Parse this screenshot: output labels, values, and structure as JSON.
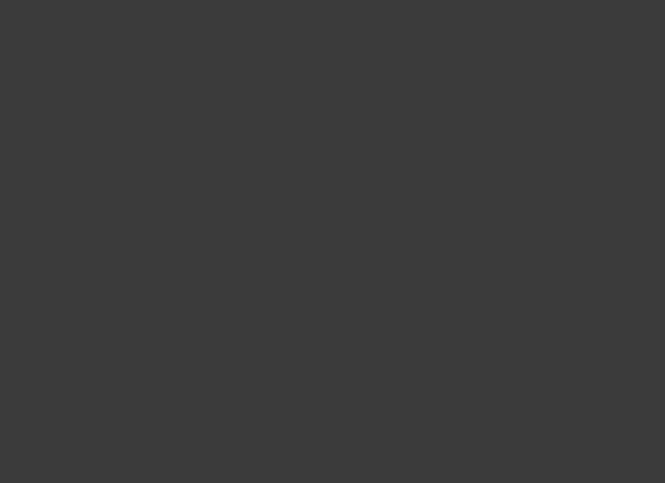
{
  "palette": {
    "frame": "#3b3b3b",
    "page": "#ebebeb",
    "floor": "#fbfbfa",
    "wall": "#1d1d1d",
    "green": "#61a23c",
    "green_line": "#a3c38b",
    "red": "#b2271a",
    "red_line": "#dfa098",
    "hatch_base": "#d9d9d9",
    "hatch_line": "#8f8f8f",
    "label": "#6b6b6b",
    "dark_fixture": "#202020"
  },
  "blocks": {
    "main": [
      88,
      55,
      560,
      373
    ],
    "top_band": [
      88,
      29,
      467,
      26
    ],
    "top_right_band": [
      555,
      29,
      93,
      26
    ],
    "left_wing": [
      38,
      112,
      50,
      343
    ],
    "top_left_block": [
      52,
      40,
      42,
      40
    ],
    "bottom_left_block": [
      88,
      390,
      222,
      65
    ],
    "restroom_block": [
      428,
      412,
      97,
      40
    ],
    "bottom_right_block": [
      555,
      390,
      93,
      68
    ],
    "skylight": [
      522,
      22,
      34,
      42
    ],
    "stair_core": [
      564,
      54,
      46,
      40
    ],
    "top_right_room": [
      612,
      56,
      36,
      48
    ],
    "rental_room": [
      555,
      135,
      73,
      87
    ],
    "kfc": [
      558,
      222,
      70,
      170
    ],
    "boh_strip": [
      152,
      58,
      22,
      172
    ],
    "right_rooms": [
      [
        628,
        146,
        20,
        44
      ],
      [
        628,
        194,
        20,
        44
      ],
      [
        628,
        242,
        20,
        44
      ],
      [
        628,
        290,
        20,
        44
      ],
      [
        628,
        338,
        20,
        44
      ],
      [
        628,
        386,
        20,
        44
      ]
    ]
  },
  "lines": {
    "grid": [
      [
        88,
        220,
        648,
        220
      ]
    ],
    "thin": [
      [
        514,
        133,
        514,
        390
      ],
      [
        556,
        133,
        556,
        282
      ],
      [
        556,
        304,
        556,
        390
      ],
      [
        150,
        400,
        310,
        400
      ],
      [
        310,
        412,
        428,
        412
      ],
      [
        428,
        428,
        525,
        428
      ],
      [
        88,
        133,
        514,
        133
      ]
    ],
    "wing_dividers": [
      [
        38,
        162,
        88,
        162
      ],
      [
        38,
        210,
        88,
        210
      ],
      [
        38,
        232,
        88,
        232
      ],
      [
        38,
        258,
        88,
        258
      ],
      [
        38,
        290,
        88,
        290
      ],
      [
        38,
        318,
        88,
        318
      ],
      [
        38,
        350,
        88,
        350
      ],
      [
        38,
        390,
        88,
        390
      ],
      [
        38,
        420,
        88,
        420
      ]
    ]
  },
  "shops_row": {
    "x0": 95,
    "y": 31,
    "count": 14,
    "step": 30.5,
    "w": 26,
    "h": 22
  },
  "dark_rows": [
    {
      "x0": 152,
      "y": 44,
      "count": 23,
      "step": 16,
      "w": 9,
      "h": 10
    },
    {
      "x0": 334,
      "y": 100,
      "count": 24,
      "step": 9.2,
      "w": 6.5,
      "h": 8
    }
  ],
  "shelf_groups": [
    {
      "id": "aisles-left-upper",
      "x": 293,
      "w": 88,
      "h": 8,
      "style": "xend",
      "ys": [
        153,
        168,
        183,
        198,
        213,
        228,
        243,
        258,
        273
      ]
    },
    {
      "id": "aisles-right-upper",
      "x": 417,
      "w": 88,
      "h": 8,
      "style": "plain",
      "ys": [
        158,
        173,
        188,
        203,
        218,
        233,
        248,
        263,
        278
      ]
    },
    {
      "id": "aisles-left-lower",
      "x": 293,
      "w": 88,
      "h": 8,
      "style": "xend",
      "ys": [
        312,
        327,
        342,
        372
      ]
    },
    {
      "id": "aisles-right-lower",
      "x": 417,
      "w": 88,
      "h": 8,
      "style": "plain",
      "ys": [
        312,
        327,
        342,
        372
      ]
    }
  ],
  "promo_rows": [
    {
      "y": 293,
      "s": 12,
      "xs": [
        298,
        326,
        354,
        382,
        428,
        456,
        484,
        506
      ]
    },
    {
      "y": 140,
      "s": 12,
      "xs": [
        300,
        330,
        360,
        428,
        458,
        488
      ]
    }
  ],
  "vshelves": {
    "x0": 336,
    "y": 58,
    "count": 8,
    "step": 17,
    "w": 10,
    "h": 40
  },
  "grid_tables": [
    [
      201,
      140,
      22,
      13
    ],
    [
      201,
      157,
      22,
      13
    ],
    [
      218,
      172,
      24,
      13
    ],
    [
      247,
      172,
      24,
      13
    ],
    [
      276,
      172,
      24,
      13
    ],
    [
      218,
      190,
      24,
      13
    ],
    [
      247,
      190,
      24,
      13
    ],
    [
      276,
      190,
      24,
      13
    ],
    [
      218,
      209,
      24,
      13
    ],
    [
      247,
      209,
      24,
      13
    ],
    [
      276,
      209,
      24,
      13
    ],
    [
      224,
      233,
      24,
      13
    ],
    [
      253,
      233,
      24,
      13
    ],
    [
      282,
      233,
      24,
      13
    ],
    [
      224,
      250,
      24,
      13
    ],
    [
      253,
      250,
      24,
      13
    ],
    [
      282,
      250,
      24,
      13
    ],
    [
      146,
      333,
      26,
      13
    ],
    [
      146,
      349,
      26,
      13
    ]
  ],
  "rings": [
    [
      147,
      132,
      40,
      36
    ],
    [
      232,
      132,
      40,
      36
    ]
  ],
  "vrings": [
    [
      205,
      314,
      29,
      48
    ],
    [
      243,
      314,
      29,
      48
    ]
  ],
  "ovals": [
    [
      142,
      182,
      50,
      14
    ],
    [
      142,
      202,
      50,
      14
    ],
    [
      142,
      239,
      50,
      13
    ]
  ],
  "freezers": [
    [
      143,
      266,
      48,
      11
    ],
    [
      199,
      266,
      34,
      11
    ],
    [
      243,
      266,
      26,
      11
    ],
    [
      143,
      284,
      48,
      11
    ],
    [
      199,
      284,
      34,
      11
    ],
    [
      243,
      284,
      26,
      11
    ]
  ],
  "circles": [
    [
      150,
      323,
      5
    ],
    [
      164,
      323,
      5
    ],
    [
      178,
      323,
      5
    ],
    [
      527,
      92,
      8
    ]
  ],
  "deli": {
    "u": [
      [
        148,
        60,
        70,
        9
      ],
      [
        148,
        88,
        70,
        9
      ],
      [
        148,
        69,
        9,
        19
      ]
    ],
    "inner": [
      170,
      72,
      26,
      13
    ],
    "blobs": [
      [
        175,
        74,
        7,
        5
      ],
      [
        185,
        74,
        7,
        5
      ]
    ]
  },
  "displays": [
    [
      232,
      60,
      11,
      30
    ],
    [
      252,
      64,
      8,
      22
    ],
    [
      268,
      58,
      13,
      34
    ],
    [
      297,
      60,
      10,
      30
    ],
    [
      315,
      64,
      8,
      22
    ],
    [
      465,
      60,
      13,
      15
    ],
    [
      465,
      82,
      13,
      15
    ],
    [
      492,
      60,
      13,
      15
    ],
    [
      492,
      82,
      13,
      15
    ]
  ],
  "pos_units": {
    "x": 519,
    "w": 20,
    "h": 16,
    "ys": [
      150,
      176,
      202,
      228,
      254,
      336,
      360,
      382
    ]
  },
  "stands": {
    "squares": [
      [
        300,
        388
      ],
      [
        326,
        388
      ],
      [
        352,
        388
      ],
      [
        492,
        388
      ]
    ],
    "sq_size": 12,
    "vrects": [
      [
        396,
        384
      ],
      [
        418,
        384
      ],
      [
        442,
        384
      ],
      [
        466,
        384
      ]
    ],
    "vr_size": [
      9,
      26
    ]
  },
  "bulk_shelves": {
    "w": 9,
    "h": 34,
    "pts": [
      [
        302,
        408
      ],
      [
        317,
        408
      ],
      [
        394,
        406
      ],
      [
        409,
        406
      ],
      [
        424,
        406
      ],
      [
        458,
        408
      ],
      [
        473,
        408
      ]
    ]
  },
  "stalls": {
    "x0": 438,
    "y": 428,
    "count": 7,
    "step": 9,
    "s": 7
  },
  "xboxes": [
    [
      582,
      93,
      13,
      14
    ],
    [
      597,
      93,
      13,
      14
    ],
    [
      110,
      428,
      15,
      20
    ],
    [
      127,
      428,
      15,
      20
    ]
  ],
  "stairs": [
    {
      "r": [
        58,
        44,
        30,
        32
      ],
      "dir": "h"
    },
    {
      "r": [
        566,
        56,
        42,
        18
      ],
      "dir": "v"
    },
    {
      "r": [
        570,
        430,
        30,
        24
      ],
      "dir": "v"
    },
    {
      "r": [
        55,
        320,
        30,
        24
      ],
      "dir": "h"
    },
    {
      "r": [
        52,
        420,
        33,
        30
      ],
      "dir": "h"
    }
  ],
  "escalator": {
    "r": [
      575,
      110,
      32,
      22
    ]
  },
  "kfc_tables": [
    [
      562,
      396,
      26,
      18
    ],
    [
      596,
      396,
      26,
      18
    ]
  ],
  "boh_compartments": {
    "x": 152,
    "w": 22,
    "y0": 62,
    "count": 12,
    "step": 14
  },
  "service_desk": {
    "arc": "M514,158 Q538,158 538,134",
    "box": [
      520,
      140,
      12,
      9
    ]
  },
  "columns": [
    [
      514,
      165
    ],
    [
      514,
      250
    ],
    [
      514,
      336
    ],
    [
      514,
      415
    ],
    [
      553,
      222
    ],
    [
      621,
      222
    ],
    [
      553,
      292
    ],
    [
      621,
      292
    ],
    [
      553,
      388
    ],
    [
      621,
      388
    ],
    [
      556,
      130
    ],
    [
      624,
      130
    ]
  ],
  "route_lines": {
    "green": [
      [
        143,
        162,
        143,
        348
      ],
      [
        196,
        118,
        196,
        388
      ],
      [
        196,
        119,
        286,
        119
      ],
      [
        239,
        119,
        239,
        388
      ],
      [
        239,
        307,
        514,
        307
      ],
      [
        239,
        364,
        514,
        364
      ]
    ],
    "red": [
      [
        286,
        119,
        286,
        362
      ],
      [
        286,
        119,
        553,
        119
      ],
      [
        286,
        296,
        512,
        296
      ],
      [
        286,
        357,
        512,
        357
      ]
    ]
  },
  "arrows": [
    {
      "id": "flow-green-1",
      "dir": "down",
      "x": 143,
      "y": 176,
      "c": "green"
    },
    {
      "id": "flow-green-2",
      "dir": "down",
      "x": 196,
      "y": 176,
      "c": "green"
    },
    {
      "id": "flow-green-3",
      "dir": "down",
      "x": 240,
      "y": 126,
      "c": "green"
    },
    {
      "id": "flow-green-4",
      "dir": "down",
      "x": 143,
      "y": 274,
      "c": "green"
    },
    {
      "id": "flow-green-5",
      "dir": "down",
      "x": 196,
      "y": 274,
      "c": "green"
    },
    {
      "id": "flow-green-6",
      "dir": "down",
      "x": 143,
      "y": 342,
      "c": "green"
    },
    {
      "id": "flow-green-7",
      "dir": "down",
      "x": 238,
      "y": 314,
      "c": "green"
    },
    {
      "id": "flow-green-8",
      "dir": "down",
      "x": 240,
      "y": 369,
      "c": "green"
    },
    {
      "id": "flow-green-9",
      "dir": "right",
      "x": 407,
      "y": 308,
      "c": "green"
    },
    {
      "id": "flow-green-10",
      "dir": "right",
      "x": 407,
      "y": 365,
      "c": "green"
    },
    {
      "id": "flow-red-1",
      "dir": "down",
      "x": 286,
      "y": 177,
      "c": "red"
    },
    {
      "id": "flow-red-2",
      "dir": "down",
      "x": 286,
      "y": 328,
      "c": "red"
    },
    {
      "id": "flow-red-3",
      "dir": "right",
      "x": 367,
      "y": 298,
      "c": "red"
    },
    {
      "id": "flow-red-4",
      "dir": "right",
      "x": 498,
      "y": 298,
      "c": "red"
    },
    {
      "id": "flow-red-5",
      "dir": "right",
      "x": 367,
      "y": 359,
      "c": "red"
    },
    {
      "id": "flow-red-6",
      "dir": "right",
      "x": 498,
      "y": 359,
      "c": "red"
    },
    {
      "id": "entrance-arrow",
      "dir": "left",
      "x": 540,
      "y": 292,
      "c": "black",
      "small": true
    }
  ],
  "labels": [
    {
      "id": "kitchenware",
      "t": "厨房用品",
      "x": 357,
      "y": 80,
      "s": 8
    },
    {
      "id": "small-appliance",
      "t": "小家电",
      "x": 404,
      "y": 80,
      "s": 8
    },
    {
      "id": "stationery-toys",
      "t": "文体玩具",
      "x": 533,
      "y": 87,
      "s": 6
    },
    {
      "id": "fruit-area",
      "t": "水果区",
      "x": 232,
      "y": 179,
      "s": 8
    },
    {
      "id": "vegetable-area",
      "t": "蔬菜区",
      "x": 243,
      "y": 231,
      "s": 8
    },
    {
      "id": "frozen-area",
      "t": "冷冻冷藏",
      "x": 102,
      "y": 247,
      "s": 8
    },
    {
      "id": "snack-puffed",
      "t": "休闲膨化",
      "x": 346,
      "y": 158,
      "s": 7
    },
    {
      "id": "snack-candy",
      "t": "休闲糖果",
      "x": 345,
      "y": 210,
      "s": 8
    },
    {
      "id": "drinks",
      "t": "酒水饮料",
      "x": 348,
      "y": 258,
      "s": 8
    },
    {
      "id": "paper-goods",
      "t": "纸 品",
      "x": 466,
      "y": 176,
      "s": 8
    },
    {
      "id": "cleaning",
      "t": "清 洁",
      "x": 466,
      "y": 200,
      "s": 7.5
    },
    {
      "id": "daily-use",
      "t": "日 用",
      "x": 464,
      "y": 235,
      "s": 8
    },
    {
      "id": "personal-care",
      "t": "洗 护",
      "x": 464,
      "y": 265,
      "s": 8
    },
    {
      "id": "bulk-food",
      "t": "散称食品",
      "x": 317,
      "y": 331,
      "s": 7
    },
    {
      "id": "health-care",
      "t": "营养保健",
      "x": 352,
      "y": 328,
      "s": 7
    },
    {
      "id": "rice-flour",
      "t": "米 面",
      "x": 460,
      "y": 323,
      "s": 8
    },
    {
      "id": "textile-bedding",
      "t": "针服床品",
      "x": 464,
      "y": 349,
      "s": 8
    },
    {
      "id": "kfc",
      "t": "肯德基",
      "x": 594,
      "y": 294,
      "s": 9
    },
    {
      "id": "entrance",
      "t": "入口",
      "x": 552,
      "y": 295,
      "s": 6.5
    },
    {
      "id": "bulk-grain",
      "t": "散称杂粮",
      "x": 299,
      "y": 423,
      "s": 6.5
    },
    {
      "id": "grain-oil",
      "t": "粮油调味",
      "x": 363,
      "y": 423,
      "s": 6.5
    },
    {
      "id": "elevator-2",
      "t": "2号电梯",
      "x": 181,
      "y": 441,
      "s": 5.5
    },
    {
      "id": "dining-elevator-hall",
      "t": "餐饮电梯厅",
      "x": 130,
      "y": 422,
      "s": 4.5
    }
  ],
  "label_boxes": [
    {
      "id": "rental-area",
      "r": [
        577,
        166,
        28,
        30
      ],
      "lines": [
        "场外",
        "租赁",
        "内198M²"
      ],
      "s": 5
    },
    {
      "id": "self-checkout",
      "r": [
        519,
        303,
        18,
        28
      ],
      "lines": [
        "自助",
        "收银区"
      ],
      "s": 4.5
    }
  ]
}
